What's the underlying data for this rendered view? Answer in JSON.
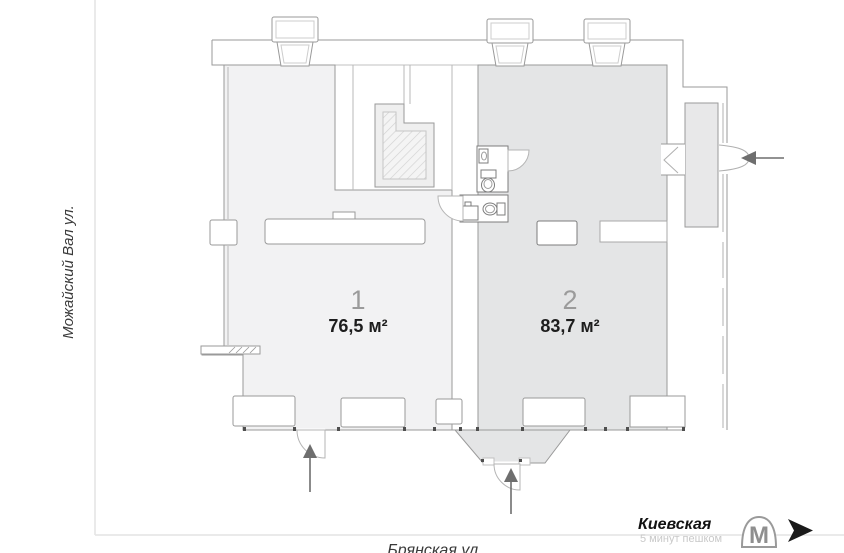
{
  "plan": {
    "units": [
      {
        "number": "1",
        "area": "76,5 м²"
      },
      {
        "number": "2",
        "area": "83,7 м²"
      }
    ]
  },
  "streets": {
    "left_label": "Можайский Вал ул.",
    "bottom_label": "Брянская ул."
  },
  "metro": {
    "station": "Киевская",
    "walk_note": "5 минут пешком",
    "logo_letter": "М"
  },
  "colors": {
    "unit1_fill": "#f2f2f3",
    "unit2_fill": "#e4e5e6",
    "vestibule_fill": "#e8e8e9",
    "wall": "#9a9a9a",
    "unit_number_text": "#9b9b9b",
    "area_text": "#1d1d1d",
    "street_text": "#3a3a3a",
    "street_line": "#e4e4e4",
    "station_text": "#121212",
    "walk_note_text": "#c9c9c9",
    "metro_logo": "#8f8f8f",
    "nav_arrow": "#1a1a1a",
    "entrance_arrow": "#6e6e6e"
  }
}
